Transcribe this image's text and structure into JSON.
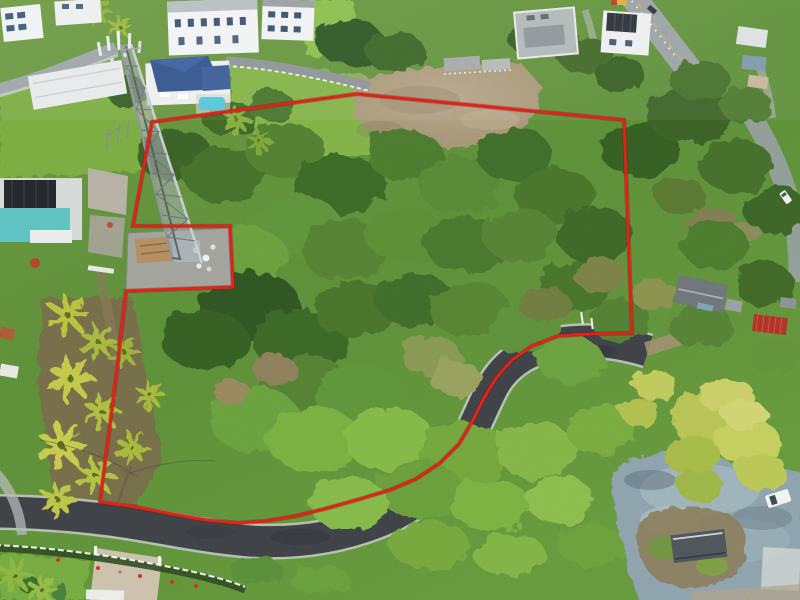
{
  "meta": {
    "title": "Aerial drone photograph of a wooded land parcel outlined with a red property boundary",
    "type": "aerial-photograph",
    "width_px": 800,
    "height_px": 600
  },
  "boundary": {
    "color": "#e0221a",
    "underlay_color": "#6b0e07",
    "stroke_width": 3,
    "points": "152,122 357,94 624,120 632,333 590,334 558,336 532,346 512,360 496,378 484,398 473,420 459,444 440,463 416,479 390,490 360,499 328,508 296,516 266,521 238,523 206,520 172,514 136,507 100,502 108,440 117,370 126,291 233,287 230,226 133,226"
  },
  "roads": {
    "main_road": {
      "d": "M -8,512 C 30,512 70,515 110,520 C 150,525 200,537 250,541 C 300,544 345,536 385,519 C 417,505 442,482 459,455 C 475,429 483,404 495,383 C 508,362 528,350 556,344 C 582,339 612,340 648,351",
      "surface_color": "#3e4146",
      "edge_color": "#c9ced1"
    },
    "highway": {
      "d": "M 629,-8 C 648,16 663,36 680,58 C 692,73 700,84 709,98",
      "surface_color": "#9ba3a7",
      "center_line_color": "#d6b544"
    },
    "highway_lower": {
      "d": "M 751,115 C 772,148 786,182 794,220 C 798,242 799,262 798,282"
    },
    "hillside_street": {
      "d": "M -5,91 C 40,79 76,64 116,48"
    },
    "fence_street": {
      "d": "M 226,61 C 268,63 318,73 370,86"
    },
    "dirt_track": {
      "d": "M 646,349 C 664,344 680,338 698,332"
    }
  },
  "palette": {
    "canopy_dark": "#2f5420",
    "canopy_mid": "#4d7c2e",
    "canopy_bright": "#85ba46",
    "lawn": "#7cae43",
    "palm_yellow_green": "#c3ca48",
    "bamboo": "#b9c554",
    "dirt_field": "#ab9a7e",
    "gravel": "#8fa4af",
    "asphalt": "#3e4146",
    "concrete": "#b8b3a6",
    "blue_roof": "#31538d",
    "teal_wall": "#5fc4c4",
    "red_roof": "#b23327",
    "pool_blue": "#54c6dc"
  },
  "landmarks": {
    "boundary_outline": "red surveyed parcel outline with notch excluding tower compound",
    "telecom_tower": "lattice telecom tower",
    "tower_compound": "fenced equipment compound at tower base",
    "blue_roof_house": "estate house with dark blue roof and pool",
    "teal_house": "modern teal house with solar roof",
    "white_mansion": "large white multi-storey house",
    "gray_modern_house": "gray flat-roof modern house",
    "solar_roof_house": "white house with rooftop solar panels",
    "red_roof_shack": "small red corrugated roof structure",
    "palm_grove": "palm grove on western slope",
    "bamboo_grove": "bamboo clump by road end",
    "dirt_field": "cleared tan dirt field",
    "gravel_clearing": "gray gravel turnaround clearing",
    "storage_container": "dark storage container",
    "white_pickup": "white pickup truck",
    "main_road": "freshly paved curving asphalt road",
    "highway": "highway along upper right edge"
  }
}
